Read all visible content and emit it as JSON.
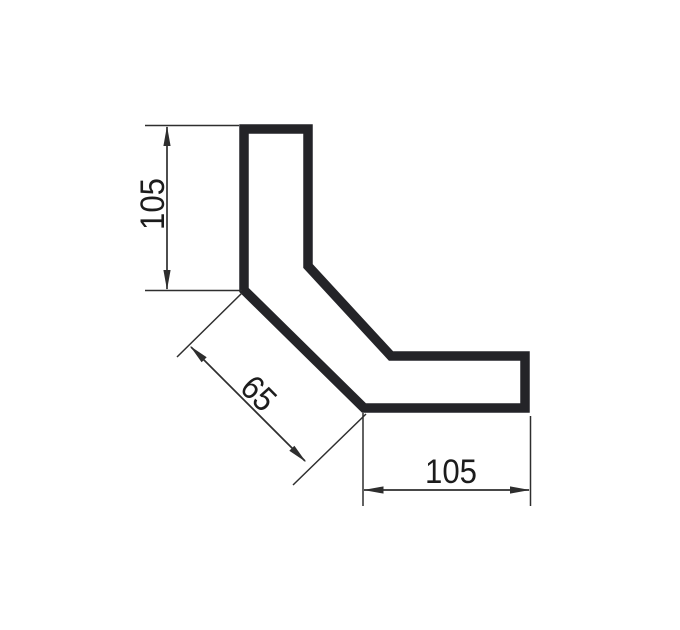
{
  "drawing": {
    "type": "technical-drawing",
    "shape": "bent-angle-profile",
    "dims": {
      "left_vertical": {
        "label": "105"
      },
      "diagonal": {
        "label": "65"
      },
      "bottom_horizontal": {
        "label": "105"
      }
    },
    "colors": {
      "outline": "#242428",
      "dimension": "#2e2e2e",
      "text": "#1c1c1c",
      "background": "#ffffff"
    }
  }
}
